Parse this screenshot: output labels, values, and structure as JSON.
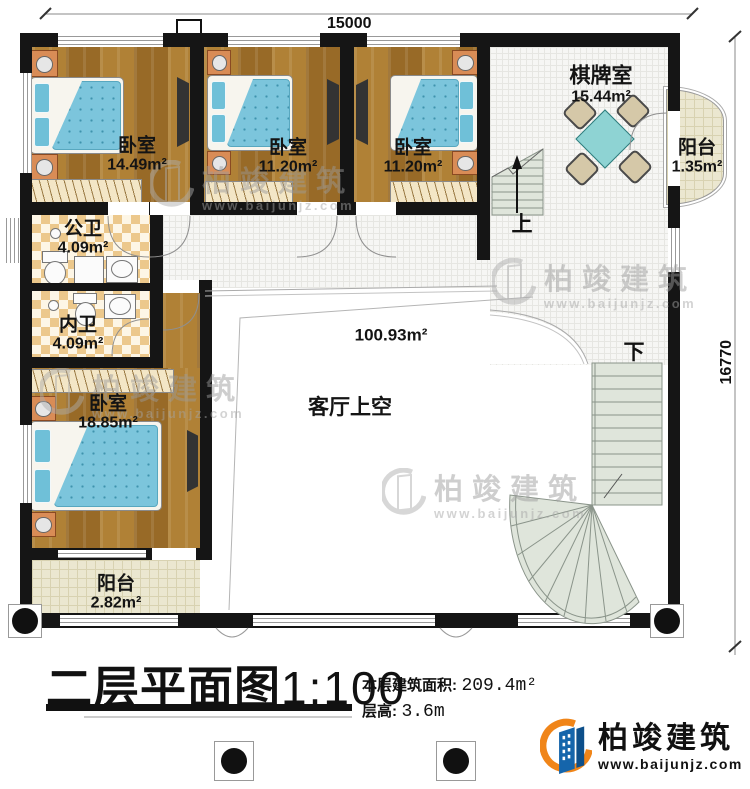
{
  "dimensions": {
    "top": "15000",
    "right": "16770"
  },
  "rooms": {
    "bedroom1": {
      "name": "卧室",
      "area": "14.49m²"
    },
    "bedroom2": {
      "name": "卧室",
      "area": "11.20m²"
    },
    "bedroom3": {
      "name": "卧室",
      "area": "11.20m²"
    },
    "chess": {
      "name": "棋牌室",
      "area": "15.44m²"
    },
    "balcony_right": {
      "name": "阳台",
      "area": "1.35m²"
    },
    "bath_public": {
      "name": "公卫",
      "area": "4.09m²"
    },
    "bath_private": {
      "name": "内卫",
      "area": "4.09m²"
    },
    "bedroom4": {
      "name": "卧室",
      "area": "18.85m²"
    },
    "void": {
      "name": "客厅上空",
      "area": "100.93m²"
    },
    "balcony_bottom": {
      "name": "阳台",
      "area": "2.82m²"
    }
  },
  "stairs": {
    "up": "上",
    "down": "下"
  },
  "title": {
    "text": "二层平面图",
    "scale": "1:100"
  },
  "info": {
    "area_label": "本层建筑面积:",
    "area_value": "209.4m²",
    "height_label": "层高:",
    "height_value": "3.6m"
  },
  "branding": {
    "logo_name": "柏竣建筑",
    "logo_url": "www.baijunjz.com"
  },
  "watermark": {
    "name": "柏竣建筑",
    "url": "www.baijunjz.com"
  },
  "colors": {
    "wall": "#151515",
    "wood": "#a9792f",
    "mattress": "#7cc5dc",
    "stair": "#dfe5db",
    "table_teal": "#8ed3d3",
    "logo_blue": "#1565ab",
    "logo_orange": "#f08519"
  }
}
